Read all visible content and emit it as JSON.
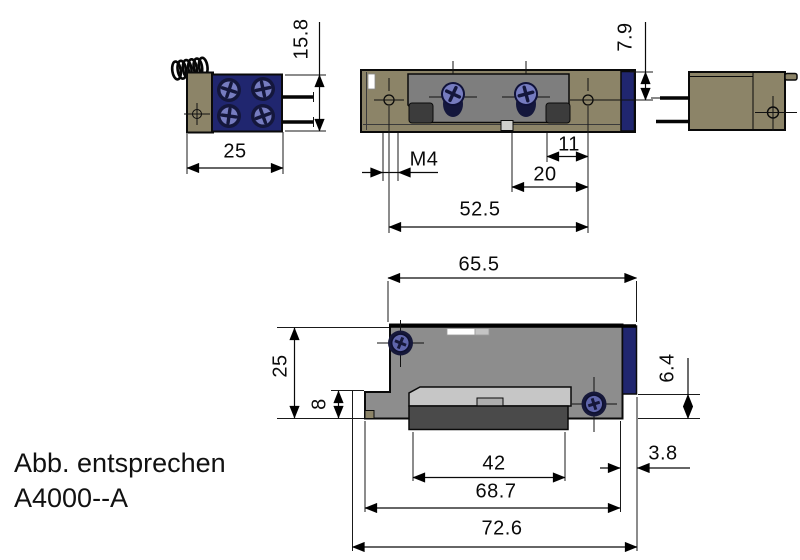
{
  "caption": {
    "line1": "Abb. entsprechen",
    "line2": "A4000--A"
  },
  "dimensions": {
    "end_height": "15.8",
    "end_width": "25",
    "top_edge_to_hole": "7.9",
    "thread_callout": "M4",
    "bump_to_hole": "11",
    "tab_to_hole": "20",
    "hole_spacing": "52.5",
    "body_width": "65.5",
    "front_height": "25",
    "step_height": "8",
    "right_inset": "6.4",
    "keeper_width": "42",
    "lip_offset": "3.8",
    "body_with_lip": "68.7",
    "overall_width": "72.6"
  },
  "colors": {
    "tan": "#8c8468",
    "navy": "#20266f",
    "screw_head": "#767cc0",
    "screw_dark": "#14173c",
    "recess": "#7e7e7e",
    "bump": "#3c3c3c",
    "body_gray": "#8d8d8d",
    "keeper_light": "#c6c6c6",
    "keeper_mid": "#aeaeae",
    "keeper_dark": "#4a4a4a",
    "line": "#0a0a0a"
  }
}
